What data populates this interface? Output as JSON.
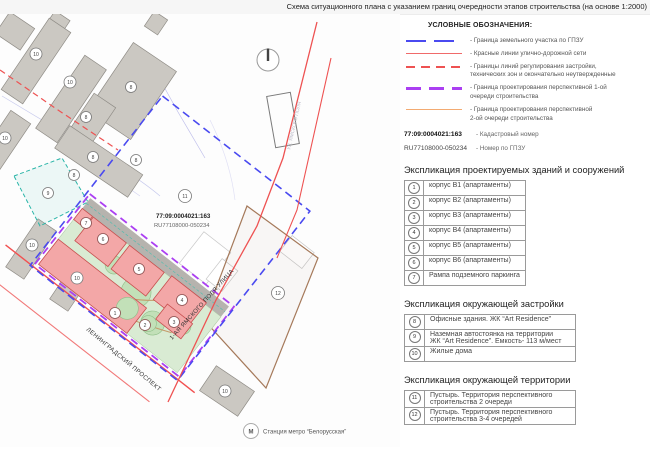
{
  "title": "Схема ситуационного плана с указанием границ очередности этапов строительства (на основе 1:2000)",
  "legend": {
    "heading": "УСЛОВНЫЕ ОБОЗНАЧЕНИЯ:",
    "items": [
      {
        "line1": "- Граница земельного участка по ГПЗУ",
        "line2": ""
      },
      {
        "line1": "- Красные линии улично-дорожной сети",
        "line2": ""
      },
      {
        "line1": "- Границы линий регулирования застройки,",
        "line2": "технических зон и окончательно неутвержденные"
      },
      {
        "line1": "- Граница проектирования перспективной 1-ой",
        "line2": "очереди строительства"
      },
      {
        "line1": "- Граница проектирования перспективной",
        "line2": "2-ой очереди строительства"
      }
    ],
    "cadastral": {
      "number": "77:09:0004021:163",
      "label": "- Кадастровый номер"
    },
    "gpzu": {
      "number": "RU77108000-050234",
      "label": "- Номер по ГПЗУ"
    }
  },
  "sections": [
    {
      "heading": "Экспликация проектируемых зданий и сооружений",
      "rows": [
        {
          "num": "1",
          "line1": "корпус В1 (апартаменты)",
          "line2": ""
        },
        {
          "num": "2",
          "line1": "корпус В2 (апартаменты)",
          "line2": ""
        },
        {
          "num": "3",
          "line1": "корпус В3 (апартаменты)",
          "line2": ""
        },
        {
          "num": "4",
          "line1": "корпус В4 (апартаменты)",
          "line2": ""
        },
        {
          "num": "5",
          "line1": "корпус В5 (апартаменты)",
          "line2": ""
        },
        {
          "num": "6",
          "line1": "корпус В6 (апартаменты)",
          "line2": ""
        },
        {
          "num": "7",
          "line1": "Рампа подземного паркинга",
          "line2": ""
        }
      ]
    },
    {
      "heading": "Экспликация окружающей застройки",
      "rows": [
        {
          "num": "8",
          "line1": "Офисные здания. ЖК “Art Residence”",
          "line2": ""
        },
        {
          "num": "9",
          "line1": "Наземная автостоянка на территории",
          "line2": "ЖК “Art Residence”. Емкость- 113 м/мест"
        },
        {
          "num": "10",
          "line1": "Жилые дома",
          "line2": ""
        }
      ]
    },
    {
      "heading": "Экспликация окружающей территории",
      "rows": [
        {
          "num": "11",
          "line1": "Пустырь. Территория перспективного",
          "line2": "строительства 2 очереди"
        },
        {
          "num": "12",
          "line1": "Пустырь. Территория перспективного",
          "line2": "строительства 3-4 очередей"
        }
      ]
    }
  ],
  "map": {
    "cadastral_number": "77:09:0004021:163",
    "gpzu_number": "RU77108000-050234",
    "streets": {
      "leningradsky": "ЛЕНИНГРАДСКИЙ ПРОСПЕКТ",
      "yamskogo": "1-АЯ ЯМСКОГО ПОЛЯ УЛИЦА",
      "yamskogo_faint": "УЛ. ЯМСКОГО ПОЛЯ"
    },
    "metro": {
      "icon": "М",
      "label": "Станция метро “Белорусская”"
    },
    "markers": [
      "10",
      "10",
      "10",
      "10",
      "10",
      "10",
      "8",
      "8",
      "8",
      "8",
      "8",
      "9",
      "11",
      "12",
      "1",
      "2",
      "3",
      "4",
      "5",
      "6",
      "7"
    ]
  },
  "colors": {
    "gpzu_boundary": "#4a4af0",
    "red_lines": "#f06a6a",
    "regulation_lines": "#ee5252",
    "phase1_boundary": "#ab3ff2",
    "phase2_boundary": "#f3ab72",
    "projected_building_fill": "#f3a7a7",
    "existing_building_fill": "#cbc8c2",
    "landscape_green": "#d9ebd3",
    "parking_teal": "#2ab5a8",
    "territory_brown": "#a5795a"
  }
}
